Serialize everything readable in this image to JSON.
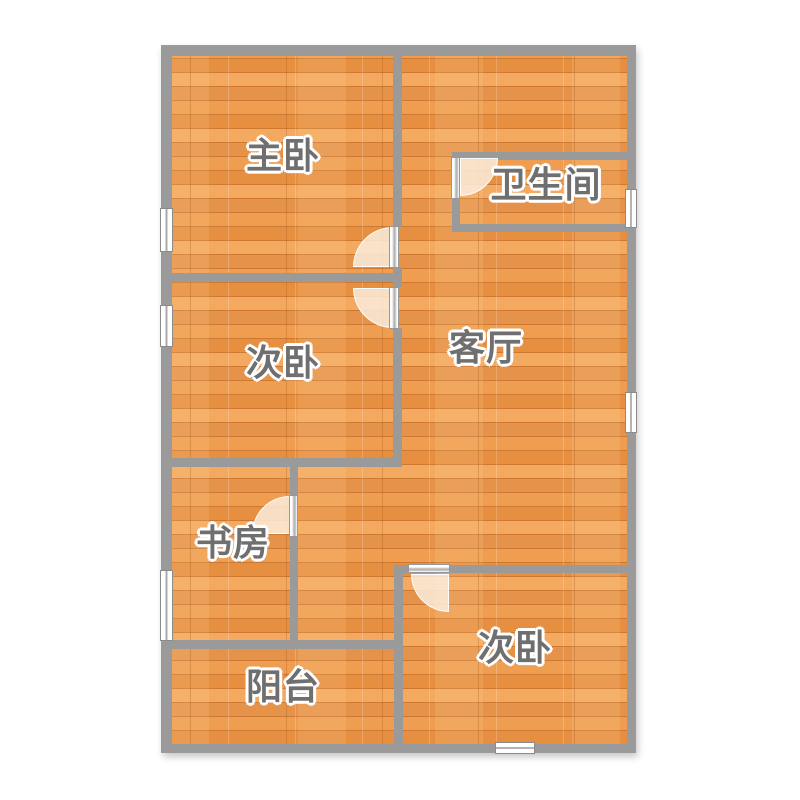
{
  "plan": {
    "rooms": [
      {
        "id": "master-bedroom",
        "label": "主卧"
      },
      {
        "id": "bathroom",
        "label": "卫生间"
      },
      {
        "id": "second-bedroom",
        "label": "次卧"
      },
      {
        "id": "living-room",
        "label": "客厅"
      },
      {
        "id": "study",
        "label": "书房"
      },
      {
        "id": "second-bedroom-2",
        "label": "次卧"
      },
      {
        "id": "balcony",
        "label": "阳台"
      }
    ],
    "colors": {
      "wall": "#9A9A9A",
      "floor_base": "#EC9A4D",
      "floor_light": "#F3A95F",
      "floor_dark": "#CE7930",
      "label_text": "#6F6F6F",
      "label_outline": "#FFFFFF",
      "door_fan": "#FAECDB",
      "window_fill": "#FFFFFF",
      "background": "#FFFFFF"
    }
  }
}
